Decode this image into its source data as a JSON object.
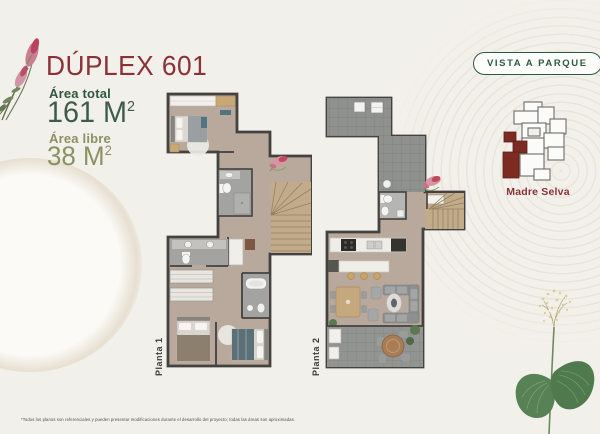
{
  "header": {
    "title": "DÚPLEX 601",
    "area_total_label": "Área total",
    "area_total_value": "161 M",
    "area_total_sup": "2",
    "area_libre_label": "Área libre",
    "area_libre_value": "38 M",
    "area_libre_sup": "2"
  },
  "badge": {
    "label": "VISTA A PARQUE"
  },
  "keyplan": {
    "label": "Madre Selva",
    "highlight_color": "#7c2a22"
  },
  "plans": [
    {
      "label": "Planta 1"
    },
    {
      "label": "Planta 2"
    }
  ],
  "footnote": "*Todos los planos son referenciales y pueden presentar modificaciones durante el desarrollo del proyecto; todas las áreas son aproximadas.",
  "colors": {
    "background": "#f2f0ea",
    "brand_red": "#8d3138",
    "dark_green": "#2c5a41",
    "olive_green": "#8c9162",
    "wall": "#434240",
    "floor": "#b8a99c",
    "tile_gray": "#8f918f",
    "stairs_tan": "#c2ab8a"
  }
}
